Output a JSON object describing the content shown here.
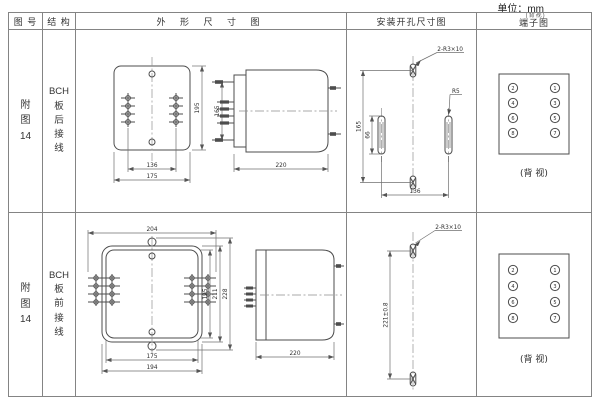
{
  "unit_label": "单位：mm",
  "header": {
    "col_figure": "图 号",
    "col_structure": "结 构",
    "col_outline": "外 形 尺 寸 图",
    "col_install": "安装开孔尺寸图",
    "col_terminal": "端子图",
    "col_terminal_note": "(背视)"
  },
  "rows": [
    {
      "figure": "附\n图\n14",
      "structure": "BCH\n板\n后\n接\n线",
      "outline": {
        "dim_width_inner": "136",
        "dim_width_outer": "175",
        "dim_height": "195",
        "dim_side_height": "165",
        "dim_depth": "220"
      },
      "install": {
        "label_slots": "2-R3×10",
        "label_radius": "R5",
        "dim_height": "165",
        "dim_slot": "66",
        "dim_width": "136"
      },
      "terminal": {
        "left": [
          "2",
          "4",
          "6",
          "8"
        ],
        "right": [
          "1",
          "3",
          "5",
          "7"
        ],
        "caption": "(背 视)"
      }
    },
    {
      "figure": "附\n图\n14",
      "structure": "BCH\n板\n前\n接\n线",
      "outline": {
        "dim_top": "204",
        "dim_h1": "195",
        "dim_h2": "211",
        "dim_h3": "228",
        "dim_bottom_inner": "175",
        "dim_bottom_outer": "194",
        "dim_depth": "220"
      },
      "install": {
        "label_slots": "2-R3×10",
        "dim_height": "221±0.8"
      },
      "terminal": {
        "left": [
          "2",
          "4",
          "6",
          "8"
        ],
        "right": [
          "1",
          "3",
          "5",
          "7"
        ],
        "caption": "(背 视)"
      }
    }
  ]
}
